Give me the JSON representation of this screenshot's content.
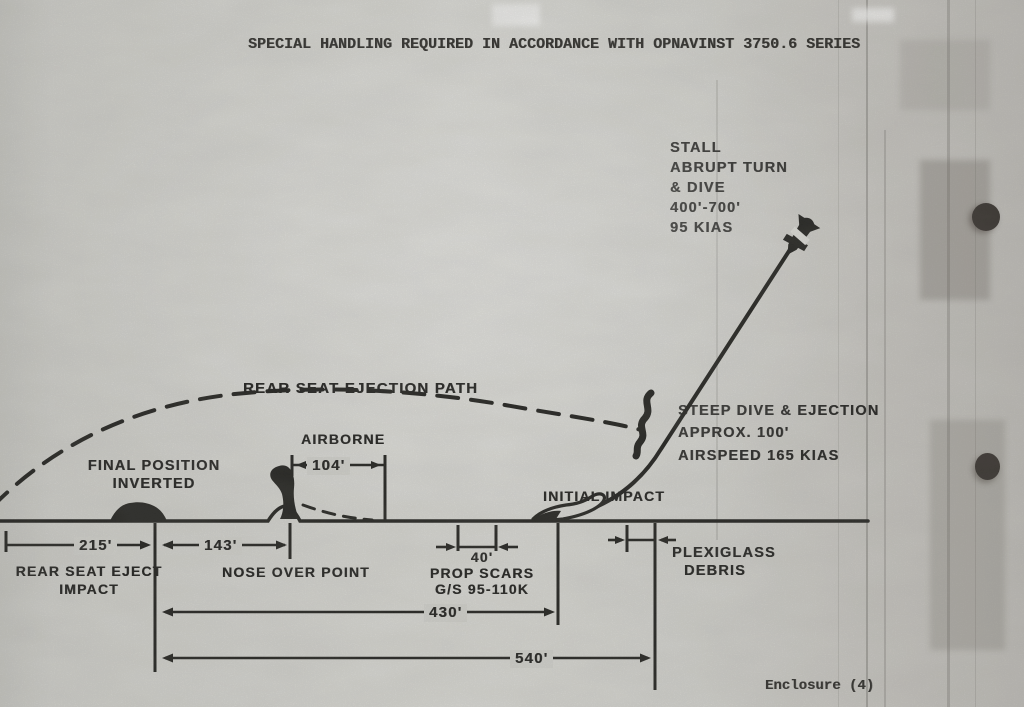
{
  "document": {
    "classification_header": "SPECIAL HANDLING REQUIRED IN ACCORDANCE WITH OPNAVINST 3750.6 SERIES",
    "enclosure_footer": "Enclosure (4)"
  },
  "diagram": {
    "stall_annotation": {
      "line1": "STALL",
      "line2": "ABRUPT TURN",
      "line3": "& DIVE",
      "line4": "400'-700'",
      "line5": "95 KIAS"
    },
    "steep_dive_annotation": {
      "line1": "STEEP DIVE & EJECTION",
      "line2": "APPROX. 100'",
      "line3": "AIRSPEED 165 KIAS"
    },
    "ejection_path_label": "REAR SEAT EJECTION PATH",
    "airborne_label": "AIRBORNE",
    "final_position_label": {
      "line1": "FINAL POSITION",
      "line2": "INVERTED"
    },
    "initial_impact_label": "INITIAL IMPACT",
    "rear_seat_eject_label": {
      "line1": "REAR SEAT EJECT",
      "line2": "IMPACT"
    },
    "nose_over_label": "NOSE OVER POINT",
    "prop_scars_label": {
      "line1": "40'",
      "line2": "PROP SCARS",
      "line3": "G/S 95-110K"
    },
    "plexiglass_label": {
      "line1": "PLEXIGLASS",
      "line2": "DEBRIS"
    },
    "dimensions": {
      "airborne_distance": "104'",
      "rear_seat_eject_distance": "215'",
      "nose_over_distance": "143'",
      "initial_impact_distance": "430'",
      "total_distance": "540'"
    }
  }
}
